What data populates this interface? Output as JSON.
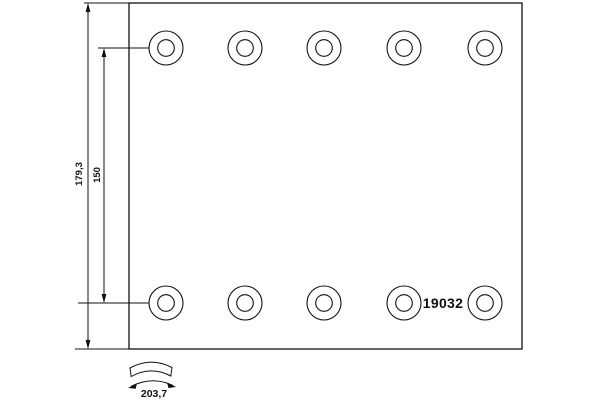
{
  "drawing": {
    "title": "brake-lining-technical-drawing",
    "part_number": "19032",
    "dimensions": {
      "total_height": "179,3",
      "hole_rows_distance": "150",
      "arc_width": "203,7"
    },
    "colors": {
      "line": "#111111",
      "background": "#ffffff"
    },
    "plate": {
      "left": 129,
      "top": 3,
      "right": 522,
      "bottom": 349
    },
    "holes": {
      "columns_x": [
        166,
        245,
        324,
        404,
        485
      ],
      "rows_y": [
        48,
        303
      ],
      "outer_radius": 17,
      "inner_radius": 8.3
    }
  }
}
